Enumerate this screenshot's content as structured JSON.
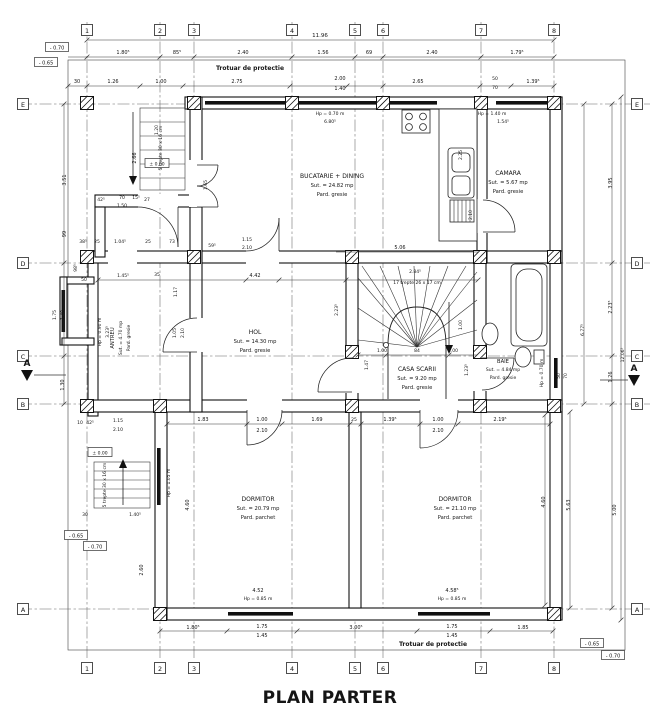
{
  "title": "PLAN PARTER",
  "notes": {
    "trotuar_top": "Trotuar de protectie",
    "trotuar_bottom": "Trotuar de protectie",
    "stair_main": "17 trepte 26 x 17 cm",
    "stair_entry_top": "5 trepte 30 x 16 cm",
    "stair_entry_side": "5 trepte 30 x 16 cm",
    "section": "A"
  },
  "grid": {
    "cols": [
      "1",
      "2",
      "3",
      "4",
      "5",
      "6",
      "7",
      "8"
    ],
    "rows": [
      "E",
      "D",
      "C",
      "B",
      "A"
    ]
  },
  "rooms": [
    {
      "name": "BUCATARIE + DINING",
      "area": "Sut. = 24.82 mp",
      "floor": "Pard. gresie"
    },
    {
      "name": "CAMARA",
      "area": "Sut. = 5.67 mp",
      "floor": "Pard. gresie"
    },
    {
      "name": "ANTREU",
      "area": "Sut. = 4.70 mp",
      "floor": "Pard. gresie"
    },
    {
      "name": "HOL",
      "area": "Sut. = 14.30 mp",
      "floor": "Pard. gresie"
    },
    {
      "name": "CASA SCARII",
      "area": "Sut. = 9.20 mp",
      "floor": "Pard. gresie"
    },
    {
      "name": "BAIE",
      "area": "Sut. = 4.84 mp",
      "floor": "Pard. gresie"
    },
    {
      "name": "DORMITOR",
      "area": "Sut. = 20.79 mp",
      "floor": "Pard. parchet"
    },
    {
      "name": "DORMITOR",
      "area": "Sut. = 21.10 mp",
      "floor": "Pard. parchet"
    }
  ],
  "elev": {
    "zero": "± 0.00",
    "m65": "- 0.65",
    "m70": "- 0.70"
  },
  "dims": {
    "top_total": "11.96",
    "top1": [
      "1.80⁵",
      "85⁵",
      "2.40",
      "1.56",
      "69",
      "2.40",
      "1.79⁵"
    ],
    "top2": [
      "30",
      "1.26",
      "1.00",
      "2.75",
      "2.00",
      "1.40",
      "2.65",
      "50",
      "70",
      "1.39⁵"
    ],
    "win_top": [
      "Hp = 0.70 m",
      "6.80⁵"
    ],
    "win_camara": [
      "Hp = 1.40 m",
      "1.54⁵"
    ],
    "left": [
      "3.51",
      "99",
      "98⁵",
      "1.75",
      "1.40",
      "1.30",
      "2.66",
      "2.60"
    ],
    "right": [
      "3.95",
      "2.23⁵",
      "1.26",
      "5.00",
      "12.06⁵",
      "6.77⁵",
      "5.63",
      "4.60"
    ],
    "bottom": [
      "1.80⁵",
      "1.75",
      "1.45",
      "3.00⁵",
      "1.75",
      "1.45",
      "1.85"
    ],
    "win_b1": [
      "4.52",
      "Hp = 0.85 m"
    ],
    "win_b2": [
      "4.58⁵",
      "Hp = 0.85 m"
    ],
    "brow": [
      "1.83",
      "1.00",
      "2.10",
      "1.69",
      "25",
      "1.39⁵",
      "1.00",
      "2.10",
      "2.19⁵"
    ],
    "drow": [
      "4.42",
      "59⁵",
      "1.15",
      "2.10",
      "5.06",
      "2.84⁵",
      "1.00",
      "84",
      "1.00"
    ],
    "stair_v": [
      "1.47",
      "1.00",
      "1.23⁵"
    ],
    "antreu": [
      "42⁵",
      "70",
      "1.50",
      "15⁵",
      "27",
      "38⁵",
      "25",
      "1.04⁵",
      "25",
      "73",
      "50",
      "1.45⁵",
      "35",
      "1.17",
      "1.05",
      "2.10"
    ],
    "hp_antreu": "Hp = 0.90 m",
    "hp_dorm": "Hp = 1.05 m",
    "hp_baie": "Hp = 0.70 m",
    "misc": [
      "2.25",
      "2.10",
      "1.65",
      "1.20",
      "2.23⁵",
      "3.23⁵",
      "1.40⁵",
      "30",
      "10",
      "42⁵",
      "1.15",
      "2.10",
      "50",
      "70"
    ]
  }
}
